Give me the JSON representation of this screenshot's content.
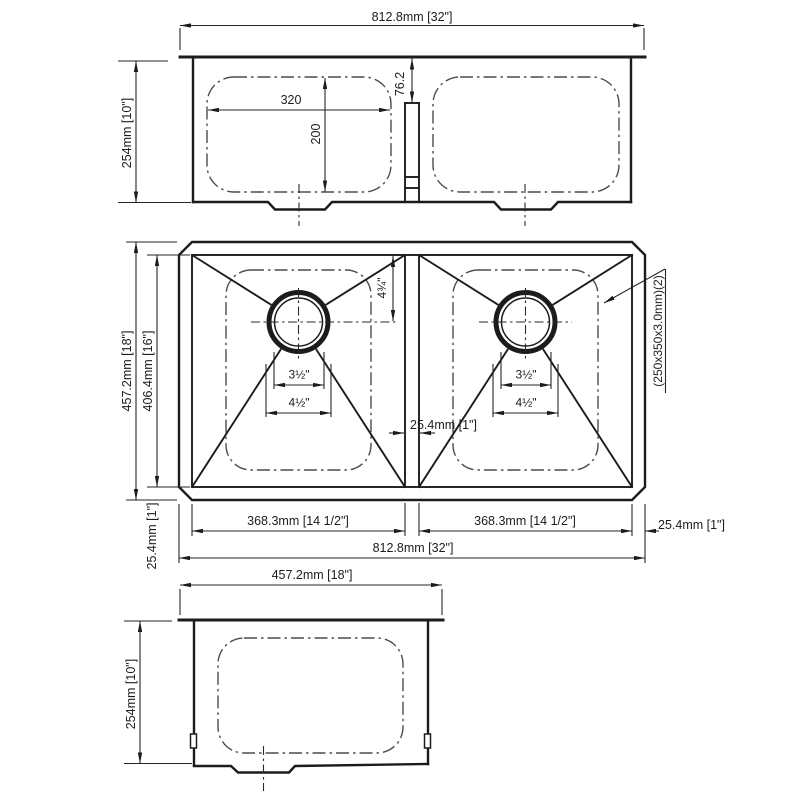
{
  "front": {
    "overall_width": "812.8mm [32\"]",
    "height": "254mm [10\"]",
    "bowl_width": "320",
    "bowl_depth": "200",
    "divider_drop": "76.2"
  },
  "plan": {
    "outer_depth": "457.2mm [18\"]",
    "inner_depth": "406.4mm [16\"]",
    "front_wall": "25.4mm [1\"]",
    "drain_offset": "4¾\"",
    "drain_inner_dia": "3½\"",
    "drain_outer_dia": "4½\"",
    "divider_width": "25.4mm [1\"]",
    "bowl_note": "(250x350x3.0mm)(2)",
    "left_bowl_width": "368.3mm [14 1/2\"]",
    "right_bowl_width": "368.3mm [14 1/2\"]",
    "side_wall": "25.4mm [1\"]",
    "overall_width": "812.8mm [32\"]"
  },
  "side": {
    "width": "457.2mm [18\"]",
    "height": "254mm [10\"]"
  },
  "colors": {
    "line": "#1c1c1c",
    "dimension": "#252525",
    "phantom_dash": "#4c4c4c",
    "background": "#ffffff"
  }
}
